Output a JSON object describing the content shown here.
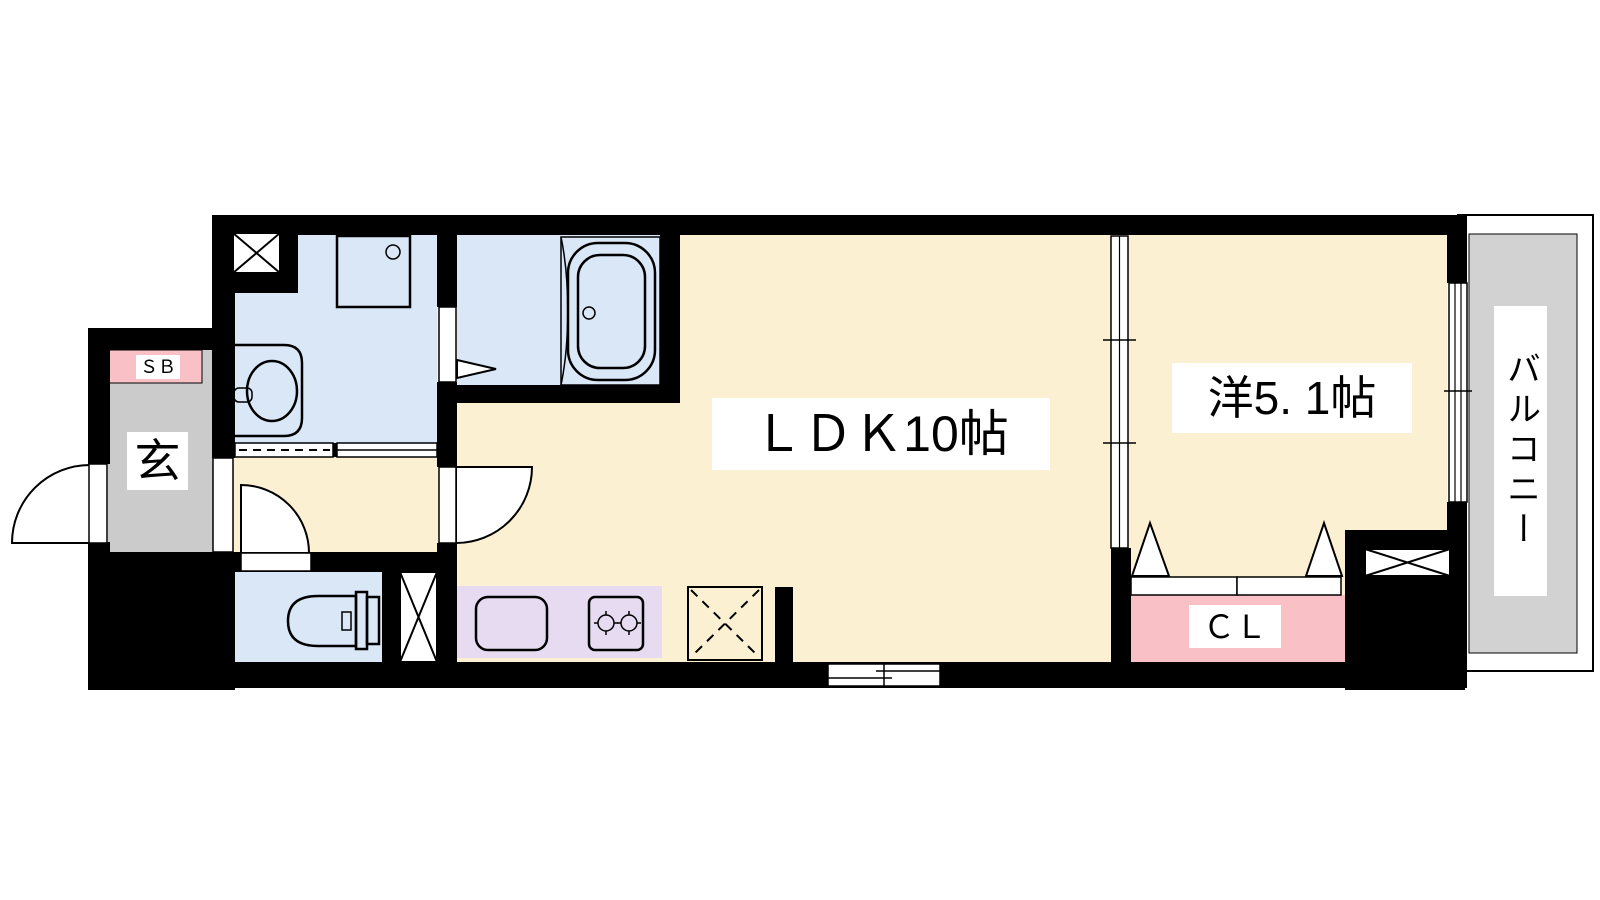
{
  "rooms": {
    "ldk": "ＬＤＫ10帖",
    "western_room": "洋5. 1帖",
    "balcony": "バルコニー",
    "entrance": "玄",
    "shoe_box": "ＳＢ",
    "closet": "ＣＬ"
  },
  "colors": {
    "wall": "#000000",
    "flooring": "#FBF0D2",
    "wet_area": "#D9E7F7",
    "kitchen_counter": "#E7DBF1",
    "storage": "#F9C0C5",
    "entrance_floor": "#CBCBCB",
    "balcony_floor": "#D2D2D2",
    "label_background": "#FFFFFF"
  }
}
